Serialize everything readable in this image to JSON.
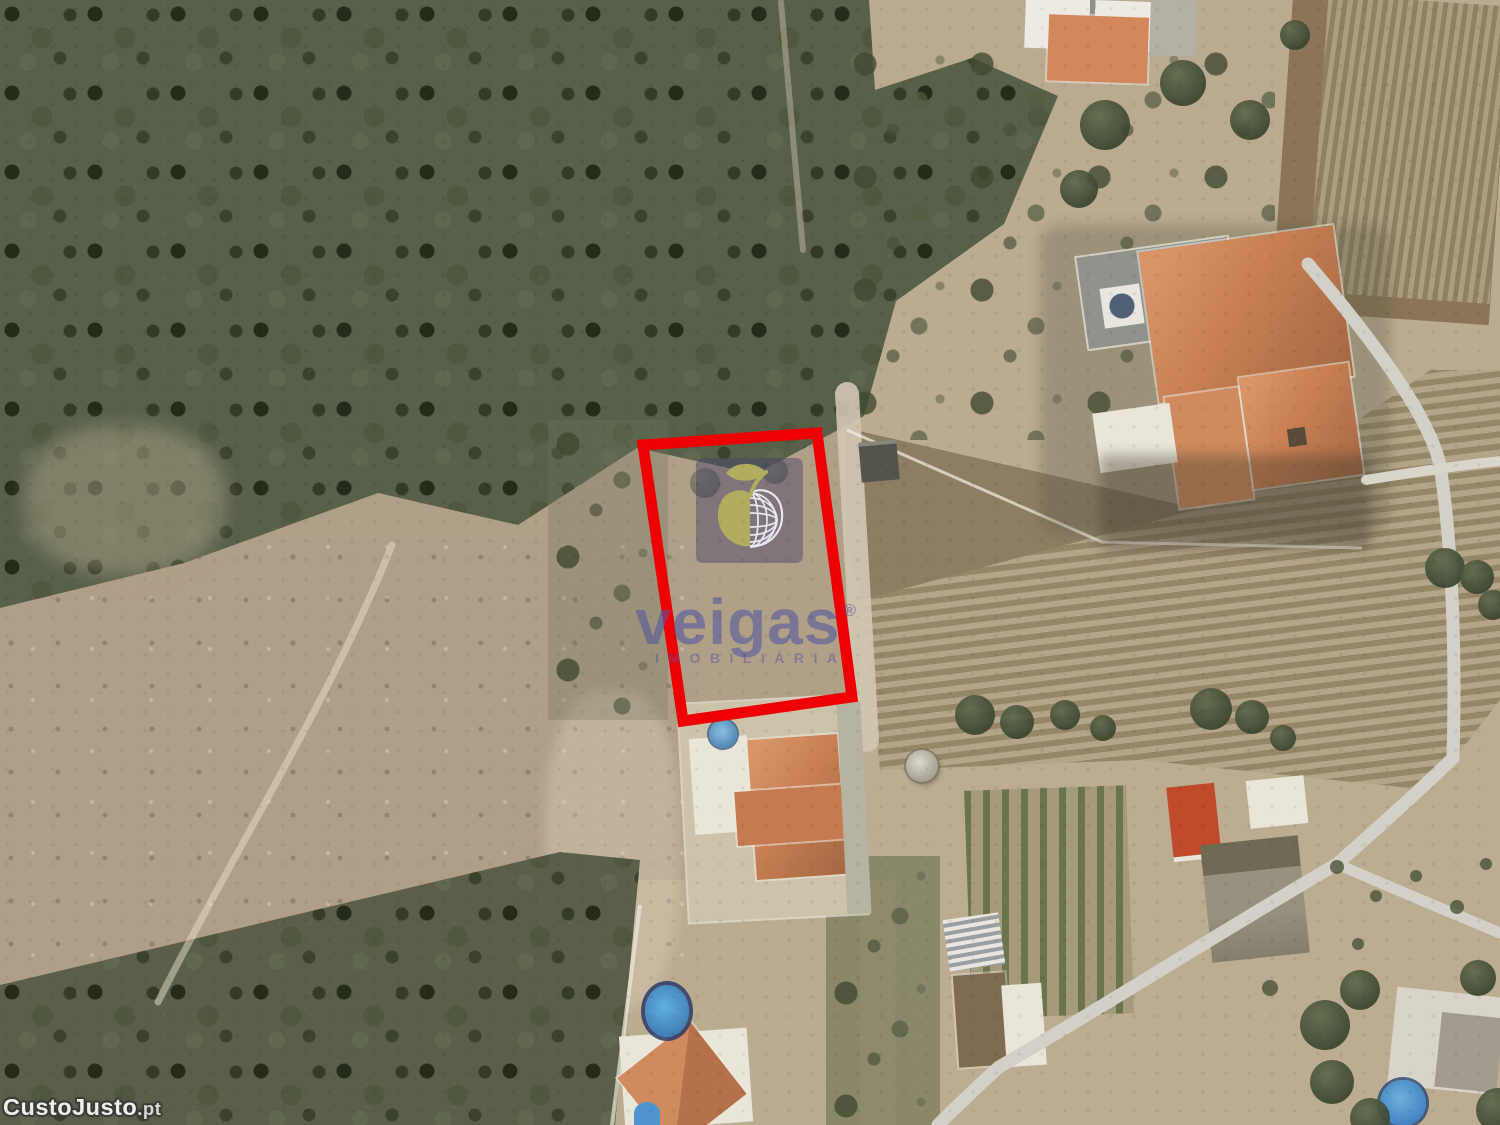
{
  "canvas": {
    "width": 1500,
    "height": 1125,
    "scene": "aerial satellite photo of a rural land plot for sale"
  },
  "watermarks": {
    "agency": {
      "name": "veigas",
      "registered_symbol": "®",
      "tagline": "IMOBILIÁRIA"
    },
    "site": {
      "name": "CustoJusto",
      "tld": ".pt"
    }
  },
  "plot_highlight": {
    "points": "643,445 817,433 852,697 683,721",
    "stroke_color": "#ee0004",
    "stroke_width": 11
  },
  "palette": {
    "terrain_base": "#b0a088",
    "forest_green": "#57604b",
    "vineyard_light": "#b4a489",
    "vineyard_dark": "#968668",
    "roof_orange": "#c67e52",
    "road_gray": "#d3d0c7",
    "pool_blue": "#4e86b4",
    "agency_text": "rgba(84,88,158,0.6)",
    "logo_square": "rgba(70,68,108,0.46)",
    "logo_apple_olive": "#b1ad5e",
    "logo_globe_lines": "#e9e7f2",
    "site_watermark_fill": "#f0efec",
    "site_watermark_outline": "#3a3a38"
  }
}
